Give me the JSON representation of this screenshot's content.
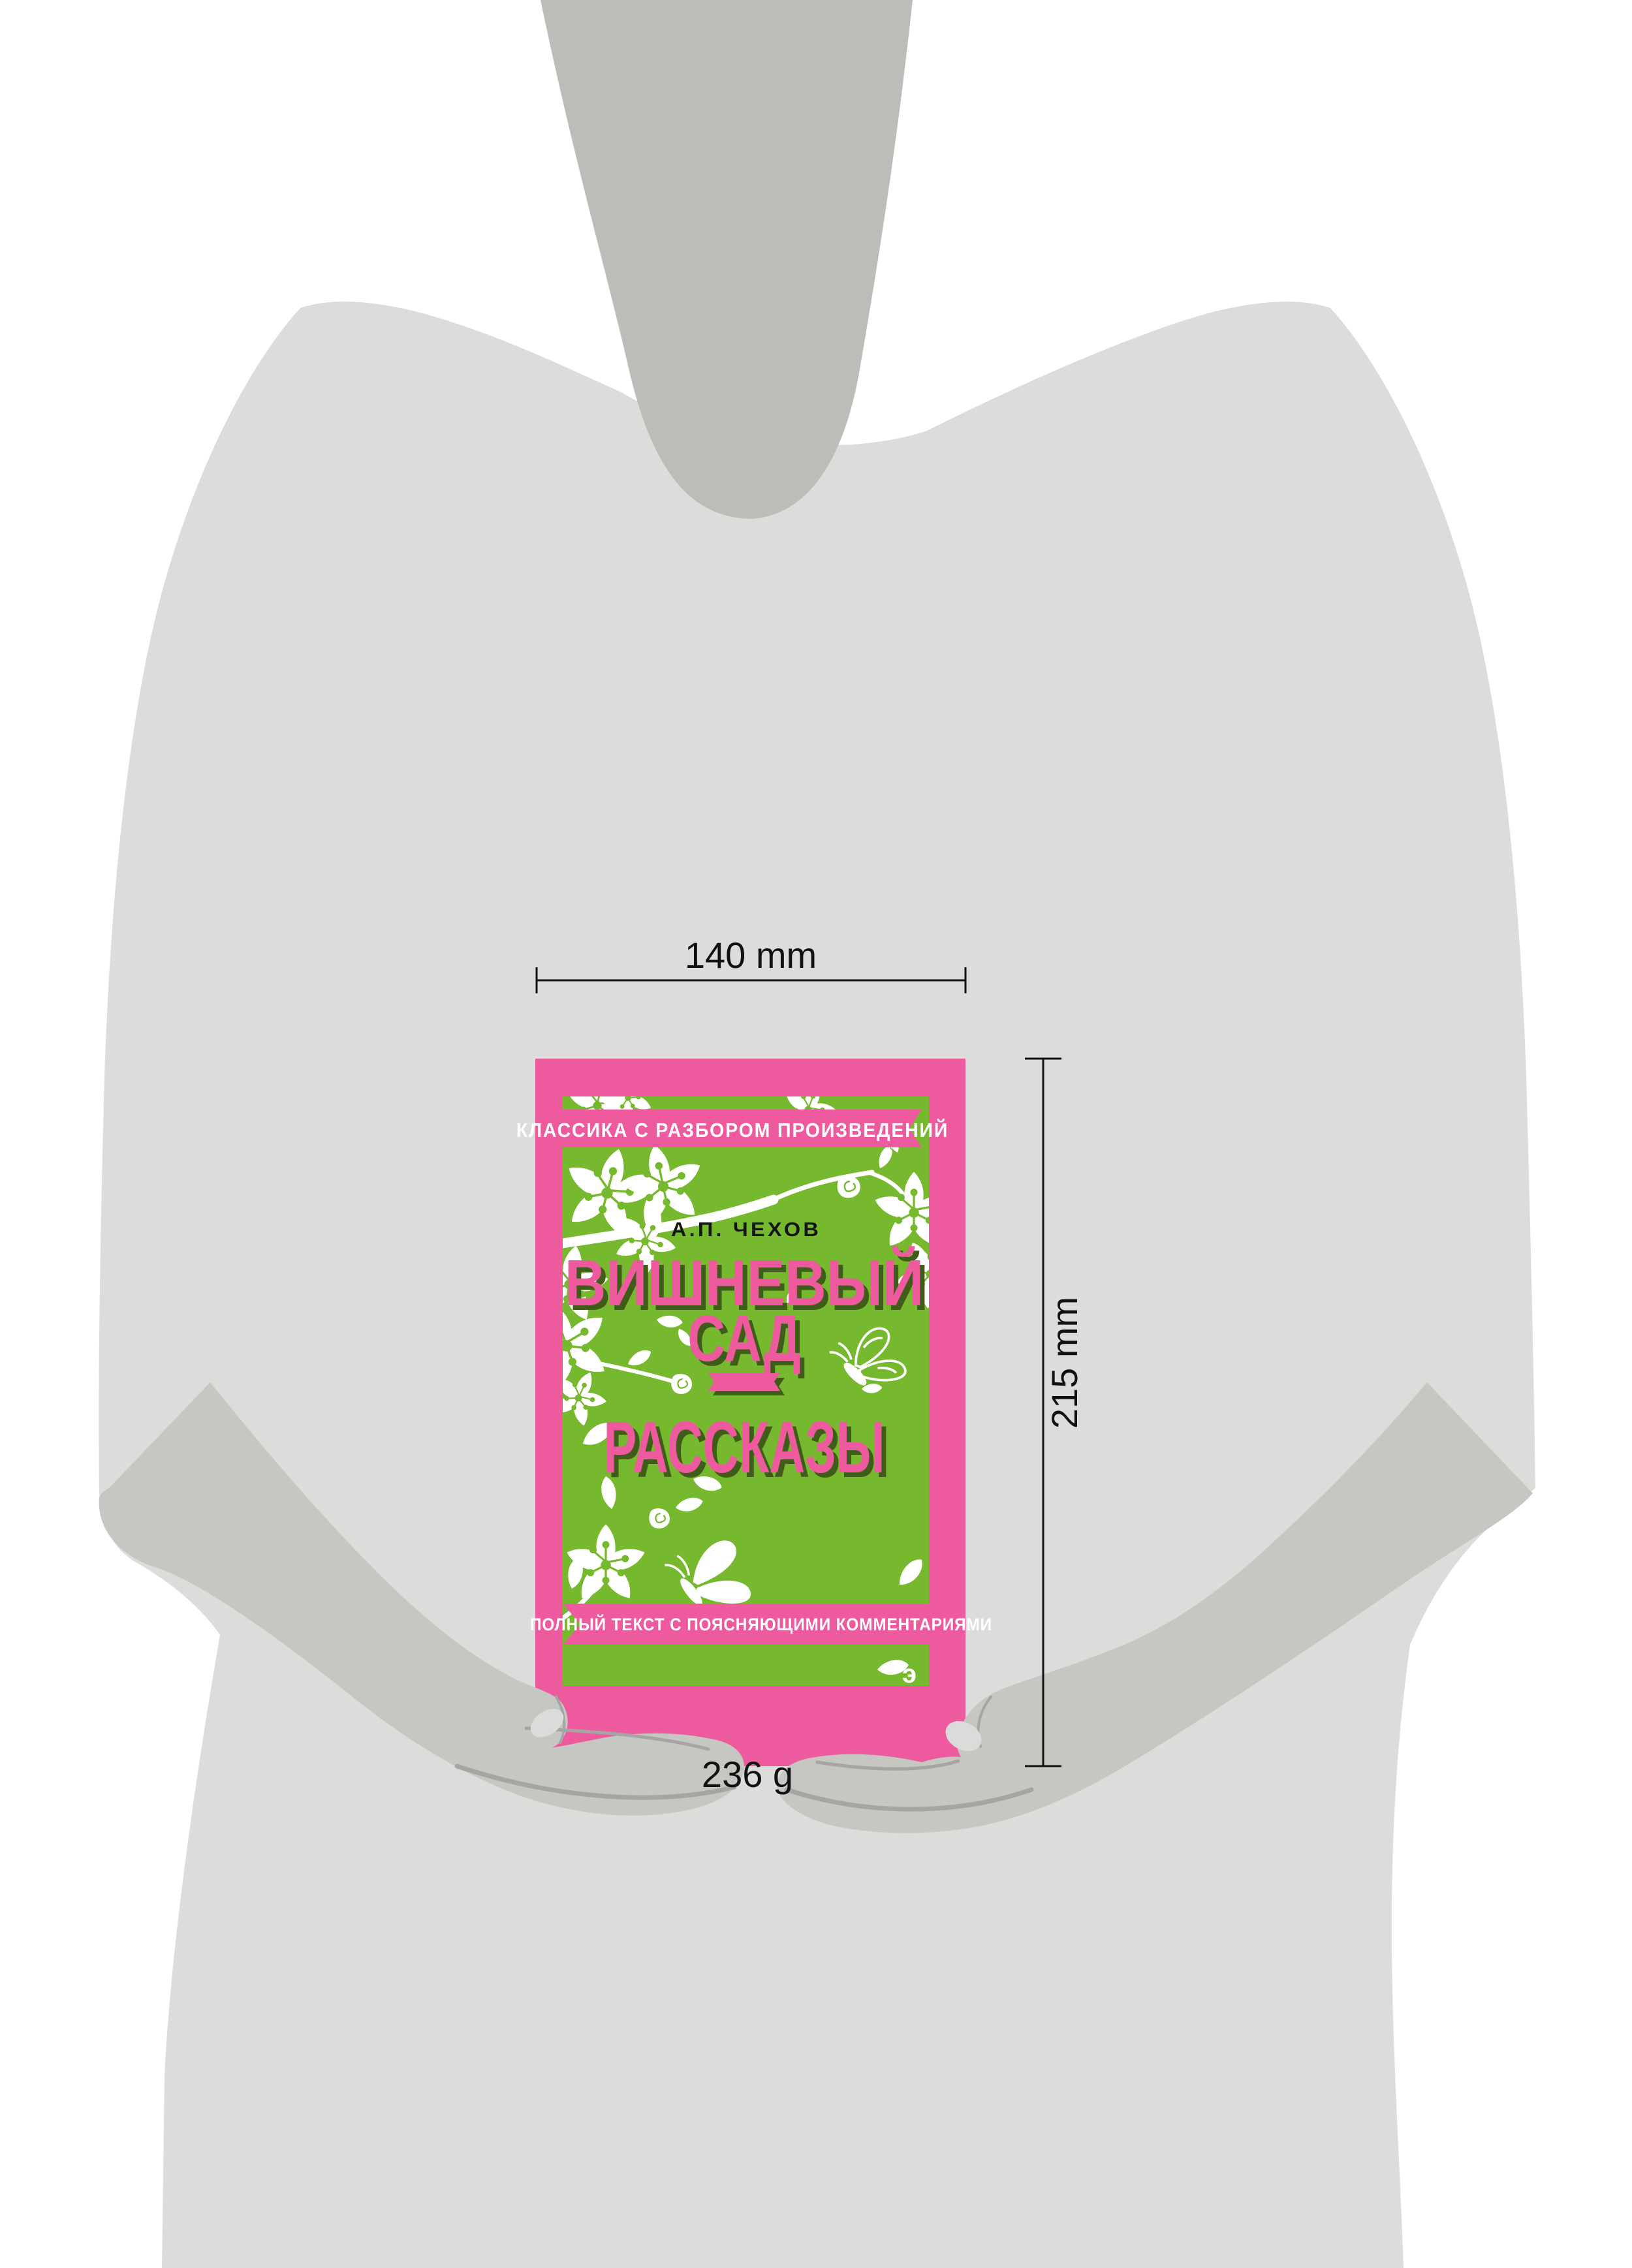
{
  "page": {
    "description": "Product size visualization: person silhouette holding a book with dimension annotations"
  },
  "dimensions": {
    "width_label": "140 mm",
    "height_label": "215 mm",
    "weight_label": "236 g"
  },
  "book_cover": {
    "series_banner": "КЛАССИКА С РАЗБОРОМ ПРОИЗВЕДЕНИЙ",
    "author": "А.П. ЧЕХОВ",
    "title_lines": [
      "ВИШНЕВЫЙ",
      "САД",
      "РАССКАЗЫ"
    ],
    "bottom_banner": "ПОЛНЫЙ ТЕКСТ С ПОЯСНЯЮЩИМИ КОММЕНТАРИЯМИ",
    "publisher_logo": "э"
  },
  "colors": {
    "pink": "#ee5a9e",
    "green": "#77b92e",
    "title_pink": "#ee5a9e",
    "title_shadow": "#3f5c19",
    "author_text": "#141414",
    "body_gray": "#dcdcda",
    "neck_gray": "#bcbcb9",
    "hand_gray": "#c6c6c3",
    "crease_gray": "#a5a5a3",
    "nail_gray": "#dbdbd9",
    "dimension_ink": "#111111",
    "background": "#ffffff",
    "flower_white": "#ffffff"
  }
}
